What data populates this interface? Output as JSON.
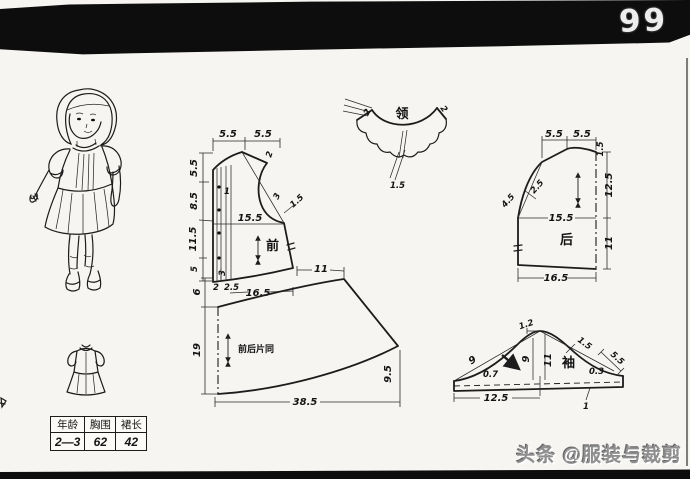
{
  "page": {
    "number": "99",
    "watermark": "头条 @服装与裁剪"
  },
  "size_table": {
    "headers": [
      "年龄",
      "胸围",
      "裙长"
    ],
    "values": [
      "2—3",
      "62",
      "42"
    ]
  },
  "pieces": {
    "front": {
      "label": "前",
      "top_left": "5.5",
      "top_right": "5.5",
      "side_1": "5.5",
      "side_2": "8.5",
      "side_3": "11.5",
      "side_4": "5",
      "placket": "1",
      "shoulder_drop": "2",
      "armhole": "3",
      "armhole_ease": "1.5",
      "chest": "15.5",
      "hem_tuck": "3",
      "hem_a": "2",
      "hem_b": "2.5",
      "hem_width": "16.5",
      "side_extension": "11"
    },
    "skirt": {
      "label": "前后片同",
      "rise": "6",
      "length": "19",
      "hem_width": "38.5",
      "side_height": "9.5"
    },
    "collar": {
      "label": "领",
      "end_left": "2",
      "end_right": "2",
      "overlap": "1.5"
    },
    "back": {
      "label": "后",
      "top_left": "5.5",
      "top_right": "5.5",
      "neck_drop": "1.5",
      "upper_length": "12.5",
      "lower_length": "11",
      "chest": "15.5",
      "armhole_a": "2.5",
      "armhole_b": "4.5",
      "hem_width": "16.5"
    },
    "sleeve": {
      "label": "袖",
      "cap_notch": "1.2",
      "cap_diagonal": "9",
      "front_dip": "0.7",
      "cap_height": "9",
      "center_height": "11",
      "back_ease": "1.5",
      "end_slope": "5.5",
      "back_dip": "0.3",
      "band_height": "1",
      "half_width": "12.5"
    }
  }
}
